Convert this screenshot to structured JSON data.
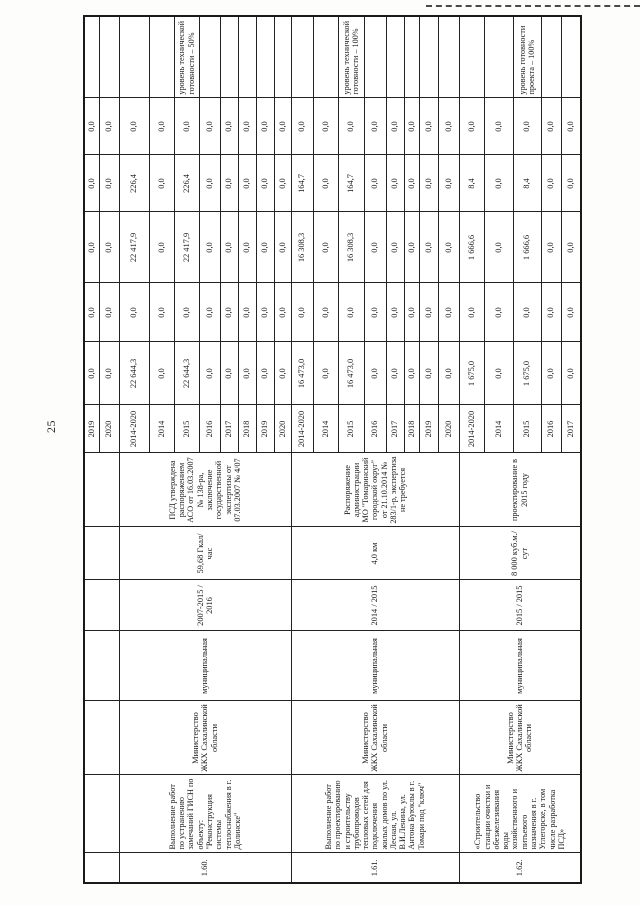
{
  "page_number": "25",
  "table": {
    "continuation_rows": [
      {
        "year": "2019",
        "values": [
          "0,0",
          "0,0",
          "0,0",
          "0,0",
          "0,0"
        ]
      },
      {
        "year": "2020",
        "values": [
          "0,0",
          "0,0",
          "0,0",
          "0,0",
          "0,0"
        ]
      }
    ],
    "groups": [
      {
        "num": "1.60.",
        "name": "Выполнение работ по устранению замечаний ГИСН по объекту: \"Реконструкция системы теплоснабжения в г. Долинске\"",
        "grbs": "Министерство ЖКХ Сахалинской области",
        "ownership": "муниципальная",
        "period": "2007-2015 / 2016",
        "capacity": "59,68 Гкал/час",
        "psd": "ПСД утверждена распоряжением АСО от 16.03.2007 № 138-ра, заключение государственной экспертизы от 07.03.2007 № 4/07",
        "level_note": "уровень технической готовности – 50%",
        "rows": [
          {
            "year": "2014-2020",
            "values": [
              "22 644,3",
              "0,0",
              "22 417,9",
              "226,4",
              "0,0"
            ]
          },
          {
            "year": "2014",
            "values": [
              "0,0",
              "0,0",
              "0,0",
              "0,0",
              "0,0"
            ]
          },
          {
            "year": "2015",
            "values": [
              "22 644,3",
              "0,0",
              "22 417,9",
              "226,4",
              "0,0"
            ]
          },
          {
            "year": "2016",
            "values": [
              "0,0",
              "0,0",
              "0,0",
              "0,0",
              "0,0"
            ]
          },
          {
            "year": "2017",
            "values": [
              "0,0",
              "0,0",
              "0,0",
              "0,0",
              "0,0"
            ]
          },
          {
            "year": "2018",
            "values": [
              "0,0",
              "0,0",
              "0,0",
              "0,0",
              "0,0"
            ]
          },
          {
            "year": "2019",
            "values": [
              "0,0",
              "0,0",
              "0,0",
              "0,0",
              "0,0"
            ]
          },
          {
            "year": "2020",
            "values": [
              "0,0",
              "0,0",
              "0,0",
              "0,0",
              "0,0"
            ]
          }
        ]
      },
      {
        "num": "1.61.",
        "name": "Выполнение работ по проектированию и строительству трубопроводов тепловых сетей для подключения жилых домов по ул. Лесная, ул. В.И.Ленина, ул. Антона Буюклы в г. Томари под \"ключ\"",
        "grbs": "Министерство ЖКХ Сахалинской области",
        "ownership": "муниципальная",
        "period": "2014 / 2015",
        "capacity": "4,0 км",
        "psd": "Распоряжение администрации МО \"Томаринский городской округ\" от 21.10.2014 № 283/1-р, экспертиза не требуется",
        "level_note": "уровень технической готовности – 100%",
        "rows": [
          {
            "year": "2014-2020",
            "values": [
              "16 473,0",
              "0,0",
              "16 308,3",
              "164,7",
              "0,0"
            ]
          },
          {
            "year": "2014",
            "values": [
              "0,0",
              "0,0",
              "0,0",
              "0,0",
              "0,0"
            ]
          },
          {
            "year": "2015",
            "values": [
              "16 473,0",
              "0,0",
              "16 308,3",
              "164,7",
              "0,0"
            ]
          },
          {
            "year": "2016",
            "values": [
              "0,0",
              "0,0",
              "0,0",
              "0,0",
              "0,0"
            ]
          },
          {
            "year": "2017",
            "values": [
              "0,0",
              "0,0",
              "0,0",
              "0,0",
              "0,0"
            ]
          },
          {
            "year": "2018",
            "values": [
              "0,0",
              "0,0",
              "0,0",
              "0,0",
              "0,0"
            ]
          },
          {
            "year": "2019",
            "values": [
              "0,0",
              "0,0",
              "0,0",
              "0,0",
              "0,0"
            ]
          },
          {
            "year": "2020",
            "values": [
              "0,0",
              "0,0",
              "0,0",
              "0,0",
              "0,0"
            ]
          }
        ]
      },
      {
        "num": "1.62.",
        "name": "«Строительство станции очистки и обезжелезивания воды хозяйственного и питьевого назначения в г. Углегорске, в том числе разработка ПСД»",
        "grbs": "Министерство ЖКХ Сахалинской области",
        "ownership": "муниципальная",
        "period": "2015 / 2015",
        "capacity": "8 000 куб.м./сут",
        "psd": "проектирование в 2015 году",
        "level_note": "уровень готовности проекта – 100%",
        "rows": [
          {
            "year": "2014-2020",
            "values": [
              "1 675,0",
              "0,0",
              "1 666,6",
              "8,4",
              "0,0"
            ]
          },
          {
            "year": "2014",
            "values": [
              "0,0",
              "0,0",
              "0,0",
              "0,0",
              "0,0"
            ]
          },
          {
            "year": "2015",
            "values": [
              "1 675,0",
              "0,0",
              "1 666,6",
              "8,4",
              "0,0"
            ]
          },
          {
            "year": "2016",
            "values": [
              "0,0",
              "0,0",
              "0,0",
              "0,0",
              "0,0"
            ]
          },
          {
            "year": "2017",
            "values": [
              "0,0",
              "0,0",
              "0,0",
              "0,0",
              "0,0"
            ]
          }
        ]
      }
    ]
  }
}
